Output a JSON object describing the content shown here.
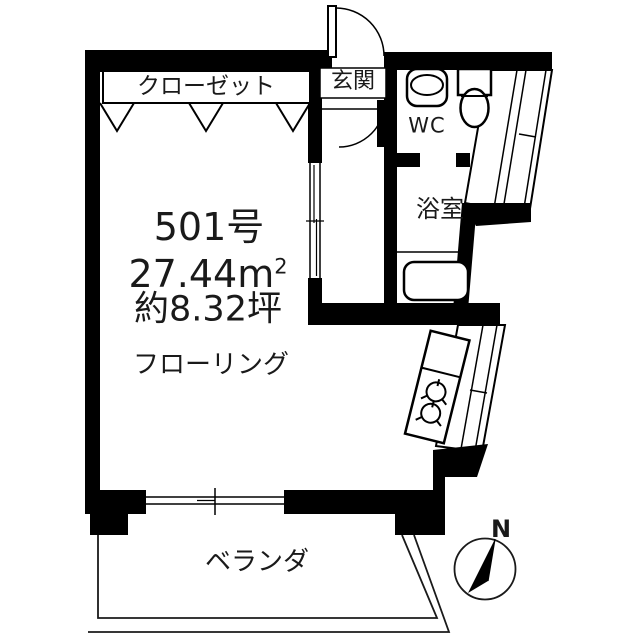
{
  "floorplan": {
    "unit_number": "501号",
    "area": {
      "m2_value": "27.44m",
      "m2_sup": "2",
      "tsubo": "約8.32坪"
    },
    "labels": {
      "closet": "クローゼット",
      "entrance": "玄関",
      "wc": "WC",
      "bath": "浴室",
      "flooring": "フローリング",
      "veranda": "ベランダ",
      "compass_north": "N"
    },
    "colors": {
      "wall": "#000000",
      "background": "#ffffff",
      "text": "#1a1a1a"
    }
  }
}
